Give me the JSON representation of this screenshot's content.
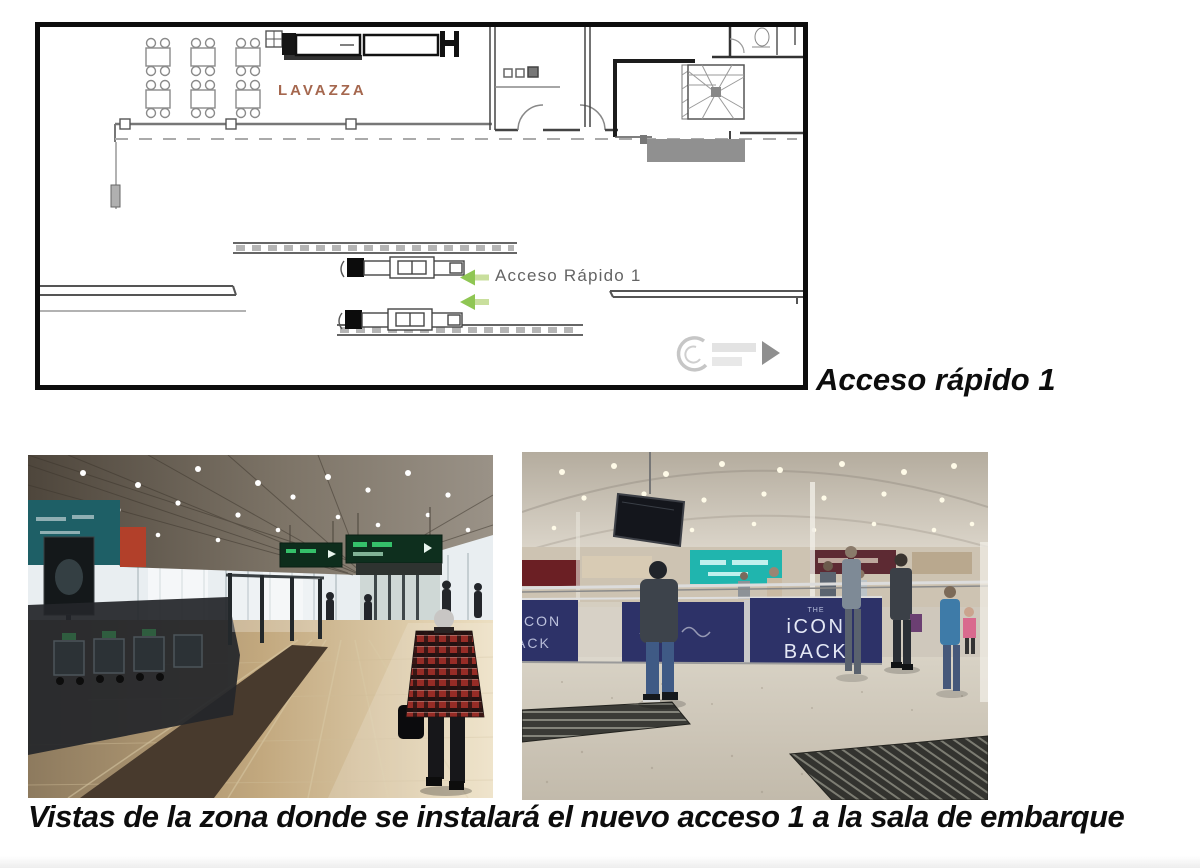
{
  "colors": {
    "lavazza": "#a5674e",
    "plan_label": "#646464",
    "arrow_head": "#8fc653",
    "arrow_tail": "#c9df9d",
    "banner_navy": "#2d3268"
  },
  "floor_plan": {
    "lavazza_label": "LAVAZZA",
    "access_label": "Acceso Rápido 1",
    "caption": "Acceso rápido 1"
  },
  "photos": {
    "caption": "Vistas de la zona donde se instalará el nuevo acceso 1 a la sala de embarque",
    "right": {
      "banner_top": "THE",
      "banner_line1": "iCON",
      "banner_line2": "BACK",
      "banner_partial_top": "CON",
      "banner_partial_bottom": "ACK"
    }
  }
}
